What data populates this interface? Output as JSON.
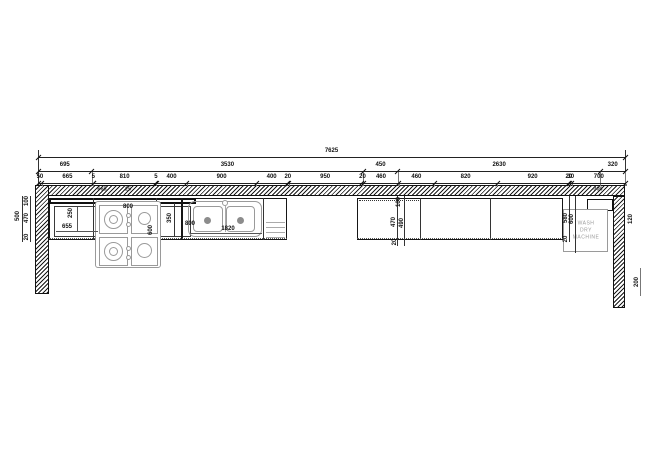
{
  "drawing": {
    "overall": {
      "values": [
        "7625"
      ]
    },
    "row2": {
      "values": [
        "695",
        "3530",
        "450",
        "2630",
        "320"
      ]
    },
    "row3": {
      "values": [
        "50",
        "665",
        "5",
        "810",
        "5",
        "400",
        "900",
        "400",
        "20",
        "950",
        "20",
        "460",
        "460",
        "820",
        "920",
        "20",
        "30",
        "700"
      ]
    },
    "labels": {
      "dim_100_left": "100",
      "dim_470_left": "470",
      "dim_20_left": "20",
      "dim_500_left": "500",
      "dim_250_cabinet": "250",
      "dim_655_cabinet": "655",
      "dim_800_cooktop": "800",
      "dim_600_cooktop": "600",
      "dim_350_sink": "350",
      "dim_800_sink": "800",
      "dim_1820_sink": "1820",
      "dim_100_mid": "100",
      "dim_470_mid": "470",
      "dim_490_mid": "490",
      "dim_20_mid": "20",
      "dim_580_right": "580",
      "dim_600_right": "600",
      "dim_20_right": "20",
      "dim_120_wall": "120",
      "dim_200_wall": "200",
      "hatch_left_a": "665",
      "hatch_left_b": "25",
      "hatch_right": "300"
    },
    "washer": {
      "lines": [
        "WASH",
        "DRY",
        "MACHINE"
      ]
    }
  }
}
